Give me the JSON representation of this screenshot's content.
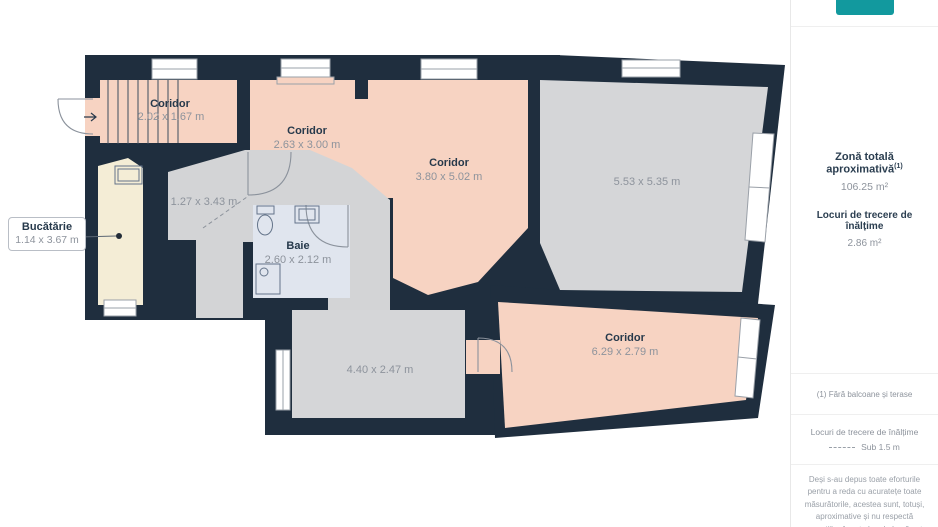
{
  "plan": {
    "rooms": [
      {
        "id": "coridor-entry",
        "name": "Coridor",
        "dims": "2.02 x 1.67 m"
      },
      {
        "id": "coridor-2",
        "name": "Coridor",
        "dims": "2.63 x 3.00 m"
      },
      {
        "id": "coridor-3",
        "name": "Coridor",
        "dims": "3.80 x 5.02 m"
      },
      {
        "id": "living",
        "name": "",
        "dims": "5.53 x 5.35 m"
      },
      {
        "id": "passage",
        "name": "",
        "dims": "1.27 x 3.43 m"
      },
      {
        "id": "bucatarie",
        "name": "Bucătărie",
        "dims": "1.14 x 3.67 m"
      },
      {
        "id": "baie",
        "name": "Baie",
        "dims": "2.60 x 2.12 m"
      },
      {
        "id": "room-2",
        "name": "",
        "dims": "4.40 x 2.47 m"
      },
      {
        "id": "coridor-4",
        "name": "Coridor",
        "dims": "6.29 x 2.79 m"
      }
    ]
  },
  "sidebar": {
    "total_area_label": "Zonă totală aproximativă",
    "total_area_footnote_ref": "(1)",
    "total_area_value": "106.25 m²",
    "passage_label": "Locuri de trecere de înălțime",
    "passage_value": "2.86 m²",
    "footnote": "(1) Fără balcoane și terase",
    "legend_title": "Locuri de trecere de înălțime",
    "legend_value": "Sub 1.5 m",
    "disclaimer": "Deși s-au depus toate eforturile pentru a reda cu acuratețe toate măsurătorile, acestea sunt, totuși, aproximative și nu respectă proporțiile. Acest plan de bază este doar ilustrativ."
  },
  "colors": {
    "wall": "#1f2e3e",
    "corridor": "#f7d3c2",
    "kitchen": "#f4edd6",
    "room_gray": "#d5d6d8",
    "bathroom": "#e0e5ee",
    "accent_teal": "#12999e"
  }
}
